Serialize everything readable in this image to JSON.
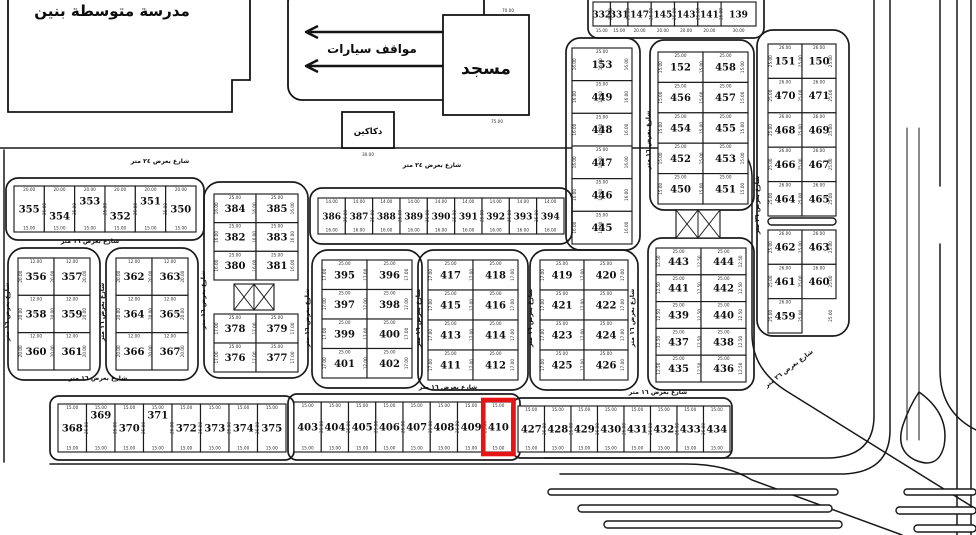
{
  "colors": {
    "ink": "#1b1b1b",
    "paper": "#ffffff",
    "highlight": "#e51515"
  },
  "highlighted_plot": "410",
  "landmarks": {
    "school": {
      "label": "مدرسة متوسطة بنين"
    },
    "parking": {
      "label": "مواقف سيارات"
    },
    "mosque": {
      "label": "مسجد",
      "dim_top": "70.00",
      "dim_bottom": "75.00"
    },
    "shops": {
      "label": "دكاكين",
      "dim_bottom": "30.00"
    }
  },
  "street_labels": [
    {
      "text": "شارع بعرض ٢٤ متر",
      "x": 160,
      "y": 163,
      "rot": 0
    },
    {
      "text": "شارع بعرض ٢٤ متر",
      "x": 432,
      "y": 167,
      "rot": 0
    },
    {
      "text": "شارع بعرض ١٦ متر",
      "x": 90,
      "y": 243,
      "rot": 0
    },
    {
      "text": "شارع بعرض ١٦ متر",
      "x": 98,
      "y": 380,
      "rot": 0
    },
    {
      "text": "شارع بعرض ١٦ متر",
      "x": 448,
      "y": 389,
      "rot": 0
    },
    {
      "text": "شارع بعرض ١٦ متر",
      "x": 658,
      "y": 394,
      "rot": 0
    },
    {
      "text": "شارع بعرض ١٦ متر",
      "x": 9,
      "y": 312,
      "rot": -90
    },
    {
      "text": "شارع بعرض ١٦ متر",
      "x": 104,
      "y": 312,
      "rot": -90
    },
    {
      "text": "شارع بعرض ١٦ متر",
      "x": 205,
      "y": 300,
      "rot": -90
    },
    {
      "text": "شارع بعرض ١٦ متر",
      "x": 309,
      "y": 318,
      "rot": -90
    },
    {
      "text": "شارع بعرض ١٦ متر",
      "x": 420,
      "y": 318,
      "rot": -90
    },
    {
      "text": "شارع بعرض ١٦ متر",
      "x": 532,
      "y": 318,
      "rot": -90
    },
    {
      "text": "شارع بعرض ١٦ متر",
      "x": 634,
      "y": 318,
      "rot": -90
    },
    {
      "text": "شارع بعرض ١٦ متر",
      "x": 650,
      "y": 140,
      "rot": -90
    },
    {
      "text": "شارع بعرض ٢٦ متر",
      "x": 759,
      "y": 205,
      "rot": -90
    },
    {
      "text": "شارع بعرض ٢٦ متر",
      "x": 790,
      "y": 370,
      "rot": -37
    }
  ],
  "service_squares": [
    {
      "x": 234,
      "y": 284,
      "w": 40,
      "h": 26
    },
    {
      "x": 676,
      "y": 210,
      "w": 44,
      "h": 28
    }
  ],
  "blocks": [
    {
      "id": "strip-north",
      "x": 593,
      "y": 2,
      "w": 163,
      "h": 24,
      "font_size": 9,
      "rows": [
        [
          "332",
          "331",
          "147",
          "145",
          "143",
          "141",
          "139"
        ]
      ],
      "weights": [
        15,
        15,
        20,
        20,
        20,
        20,
        30
      ],
      "dim_bottom": [
        "15.00",
        "15.00",
        "20.00",
        "20.00",
        "20.00",
        "20.00",
        "30.00"
      ],
      "dim_bottom_outside": true,
      "dim_side": "25.00",
      "outline": {
        "x": 588,
        "y": -12,
        "w": 176,
        "h": 50,
        "rx": 10
      }
    },
    {
      "id": "col-east-a",
      "x": 768,
      "y": 44,
      "w": 68,
      "h": 172,
      "rows": [
        [
          "151",
          "150"
        ],
        [
          "470",
          "471"
        ],
        [
          "468",
          "469"
        ],
        [
          "466",
          "467"
        ],
        [
          "464",
          "465"
        ]
      ],
      "dim_top": "26.00",
      "dim_side": "25.00",
      "outline": {
        "x": 757,
        "y": 30,
        "w": 92,
        "h": 306,
        "rx": 16
      }
    },
    {
      "id": "col-east-b",
      "x": 768,
      "y": 230,
      "w": 68,
      "h": 103,
      "rows": [
        [
          "462",
          "463"
        ],
        [
          "461",
          "460"
        ],
        [
          "459",
          null
        ]
      ],
      "dim_top": "26.00",
      "dim_side": "25.00"
    },
    {
      "id": "col-153",
      "x": 572,
      "y": 48,
      "w": 60,
      "h": 196,
      "rows": [
        [
          "153"
        ],
        [
          "449"
        ],
        [
          "448"
        ],
        [
          "447"
        ],
        [
          "446"
        ],
        [
          "445"
        ]
      ],
      "dim_top": "25.00",
      "dim_side": "16.00",
      "outline": {
        "x": 566,
        "y": 38,
        "w": 74,
        "h": 212,
        "rx": 14
      }
    },
    {
      "id": "block-152",
      "x": 658,
      "y": 52,
      "w": 90,
      "h": 152,
      "rows": [
        [
          "152",
          "458"
        ],
        [
          "456",
          "457"
        ],
        [
          "454",
          "455"
        ],
        [
          "452",
          "453"
        ],
        [
          "450",
          "451"
        ]
      ],
      "dim_top": "25.00",
      "dim_side": "15.00",
      "outline": {
        "x": 650,
        "y": 40,
        "w": 104,
        "h": 170,
        "rx": 14
      }
    },
    {
      "id": "block-443",
      "x": 656,
      "y": 248,
      "w": 90,
      "h": 134,
      "rows": [
        [
          "443",
          "444"
        ],
        [
          "441",
          "442"
        ],
        [
          "439",
          "440"
        ],
        [
          "437",
          "438"
        ],
        [
          "435",
          "436"
        ]
      ],
      "dim_top": "25.00",
      "dim_side": "12.50",
      "outline": {
        "x": 648,
        "y": 238,
        "w": 106,
        "h": 152,
        "rx": 14
      }
    },
    {
      "id": "row-355",
      "x": 14,
      "y": 186,
      "w": 182,
      "h": 46,
      "rows": [
        [
          "355",
          "354",
          "353",
          "352",
          "351",
          "350"
        ]
      ],
      "dim_top": "20.00",
      "dim_bottom": "15.00",
      "dim_side": "25.00",
      "label_dy": {
        "354": 7,
        "353": -8,
        "352": 7,
        "351": -8
      },
      "outline": {
        "x": 6,
        "y": 178,
        "w": 198,
        "h": 62,
        "rx": 12
      }
    },
    {
      "id": "block-356",
      "x": 18,
      "y": 258,
      "w": 72,
      "h": 112,
      "rows": [
        [
          "356",
          "357"
        ],
        [
          "358",
          "359"
        ],
        [
          "360",
          "361"
        ]
      ],
      "dim_top": "12.00",
      "dim_side": "20.00",
      "outline": {
        "x": 8,
        "y": 248,
        "w": 92,
        "h": 132,
        "rx": 16
      }
    },
    {
      "id": "block-362",
      "x": 116,
      "y": 258,
      "w": 72,
      "h": 112,
      "rows": [
        [
          "362",
          "363"
        ],
        [
          "364",
          "365"
        ],
        [
          "366",
          "367"
        ]
      ],
      "dim_top": "12.00",
      "dim_side": "20.00",
      "outline": {
        "x": 106,
        "y": 248,
        "w": 92,
        "h": 132,
        "rx": 16
      }
    },
    {
      "id": "block-384",
      "x": 214,
      "y": 194,
      "w": 84,
      "h": 86,
      "rows": [
        [
          "384",
          "385"
        ],
        [
          "382",
          "383"
        ],
        [
          "380",
          "381"
        ]
      ],
      "dim_top": "25.00",
      "dim_side": "16.00",
      "outline": {
        "x": 204,
        "y": 182,
        "w": 104,
        "h": 196,
        "rx": 16
      }
    },
    {
      "id": "block-378",
      "x": 214,
      "y": 314,
      "w": 84,
      "h": 58,
      "rows": [
        [
          "378",
          "379"
        ],
        [
          "376",
          "377"
        ]
      ],
      "dim_top": "25.00",
      "dim_side": "17.00"
    },
    {
      "id": "strip-386",
      "x": 318,
      "y": 198,
      "w": 246,
      "h": 36,
      "font_size": 9,
      "rows": [
        [
          "386",
          "387",
          "388",
          "389",
          "390",
          "391",
          "392",
          "393",
          "394"
        ]
      ],
      "dim_top": "14.00",
      "dim_bottom": "16.00",
      "dim_side": "25.00",
      "outline": {
        "x": 310,
        "y": 188,
        "w": 262,
        "h": 56,
        "rx": 12
      }
    },
    {
      "id": "block-395",
      "x": 322,
      "y": 260,
      "w": 90,
      "h": 118,
      "rows": [
        [
          "395",
          "396"
        ],
        [
          "397",
          "398"
        ],
        [
          "399",
          "400"
        ],
        [
          "401",
          "402"
        ]
      ],
      "dim_top": "25.00",
      "dim_side": "17.00",
      "outline": {
        "x": 312,
        "y": 250,
        "w": 110,
        "h": 138,
        "rx": 16
      }
    },
    {
      "id": "block-417",
      "x": 428,
      "y": 260,
      "w": 90,
      "h": 120,
      "rows": [
        [
          "417",
          "418"
        ],
        [
          "415",
          "416"
        ],
        [
          "413",
          "414"
        ],
        [
          "411",
          "412"
        ]
      ],
      "dim_top": "25.00",
      "dim_side": "17.00",
      "outline": {
        "x": 418,
        "y": 250,
        "w": 110,
        "h": 140,
        "rx": 16
      }
    },
    {
      "id": "block-419",
      "x": 540,
      "y": 260,
      "w": 88,
      "h": 120,
      "rows": [
        [
          "419",
          "420"
        ],
        [
          "421",
          "422"
        ],
        [
          "423",
          "424"
        ],
        [
          "425",
          "426"
        ]
      ],
      "dim_top": "25.00",
      "dim_side": "17.00",
      "outline": {
        "x": 530,
        "y": 250,
        "w": 108,
        "h": 140,
        "rx": 16
      }
    },
    {
      "id": "strip-368",
      "x": 58,
      "y": 404,
      "w": 228,
      "h": 48,
      "rows": [
        [
          "368",
          "369",
          "370",
          "371",
          "372",
          "373",
          "374",
          "375"
        ]
      ],
      "dim_top": "15.00",
      "dim_bottom": "15.00",
      "dim_side": "25.00",
      "label_dy": {
        "369": -13,
        "371": -13
      },
      "outline": {
        "x": 50,
        "y": 396,
        "w": 244,
        "h": 64,
        "rx": 9
      }
    },
    {
      "id": "strip-403",
      "x": 294,
      "y": 402,
      "w": 218,
      "h": 50,
      "rows": [
        [
          "403",
          "404",
          "405",
          "406",
          "407",
          "408",
          "409",
          "410"
        ]
      ],
      "dim_top": "15.00",
      "dim_bottom": "15.00",
      "dim_side": "25.00",
      "outline": {
        "x": 288,
        "y": 394,
        "w": 232,
        "h": 66,
        "rx": 9
      }
    },
    {
      "id": "strip-427",
      "x": 518,
      "y": 406,
      "w": 212,
      "h": 46,
      "rows": [
        [
          "427",
          "428",
          "429",
          "430",
          "431",
          "432",
          "433",
          "434"
        ]
      ],
      "dim_top": "15.00",
      "dim_bottom": "15.00",
      "dim_side": "25.00",
      "outline": {
        "x": 512,
        "y": 398,
        "w": 220,
        "h": 60,
        "rx": 9
      }
    }
  ]
}
